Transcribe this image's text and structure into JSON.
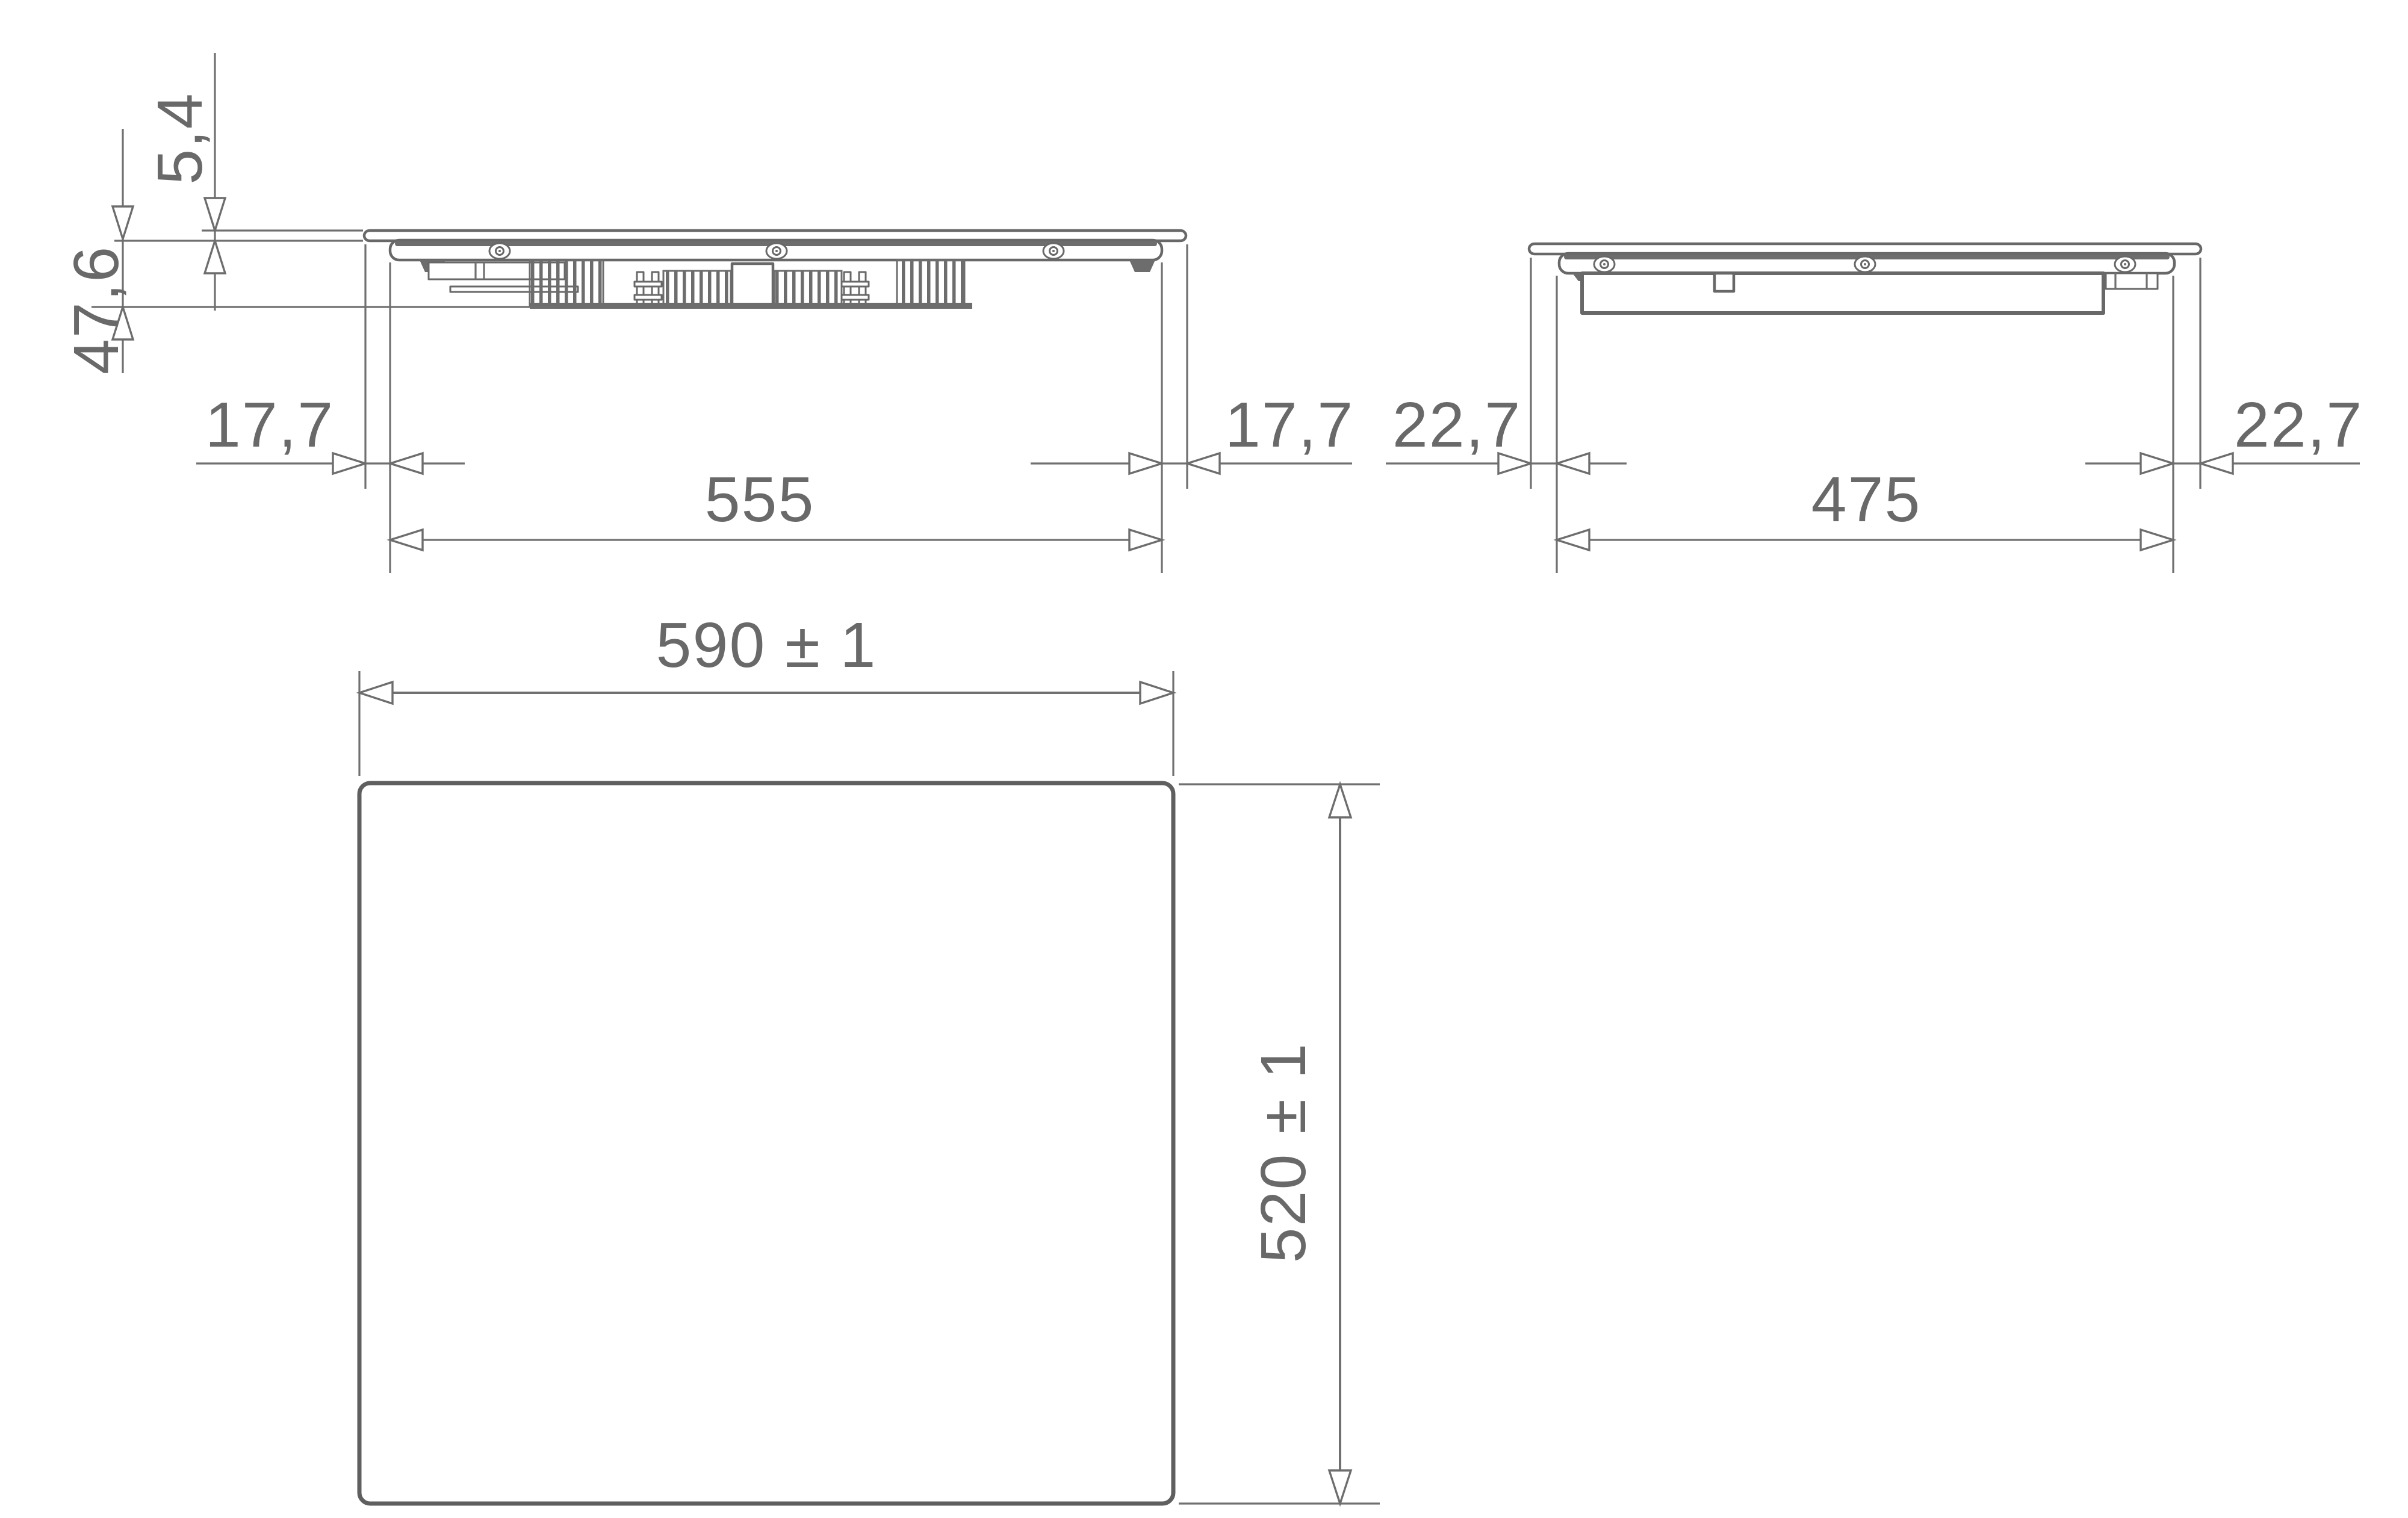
{
  "views": {
    "front": {
      "title": "front-elevation",
      "labels": {
        "glass_thickness": "5,4",
        "body_height": "47,6",
        "left_overhang": "17,7",
        "body_width": "555",
        "right_overhang": "17,7"
      }
    },
    "side": {
      "title": "side-elevation",
      "labels": {
        "left_overhang": "22,7",
        "body_depth": "475",
        "right_overhang": "22,7"
      }
    },
    "cutout": {
      "title": "worktop-cutout-plan",
      "labels": {
        "width": "590 ± 1",
        "depth": "520 ± 1"
      }
    }
  },
  "colors": {
    "line": "#686868",
    "dimension_line": "#707070",
    "text": "#696969",
    "background": "#ffffff"
  }
}
